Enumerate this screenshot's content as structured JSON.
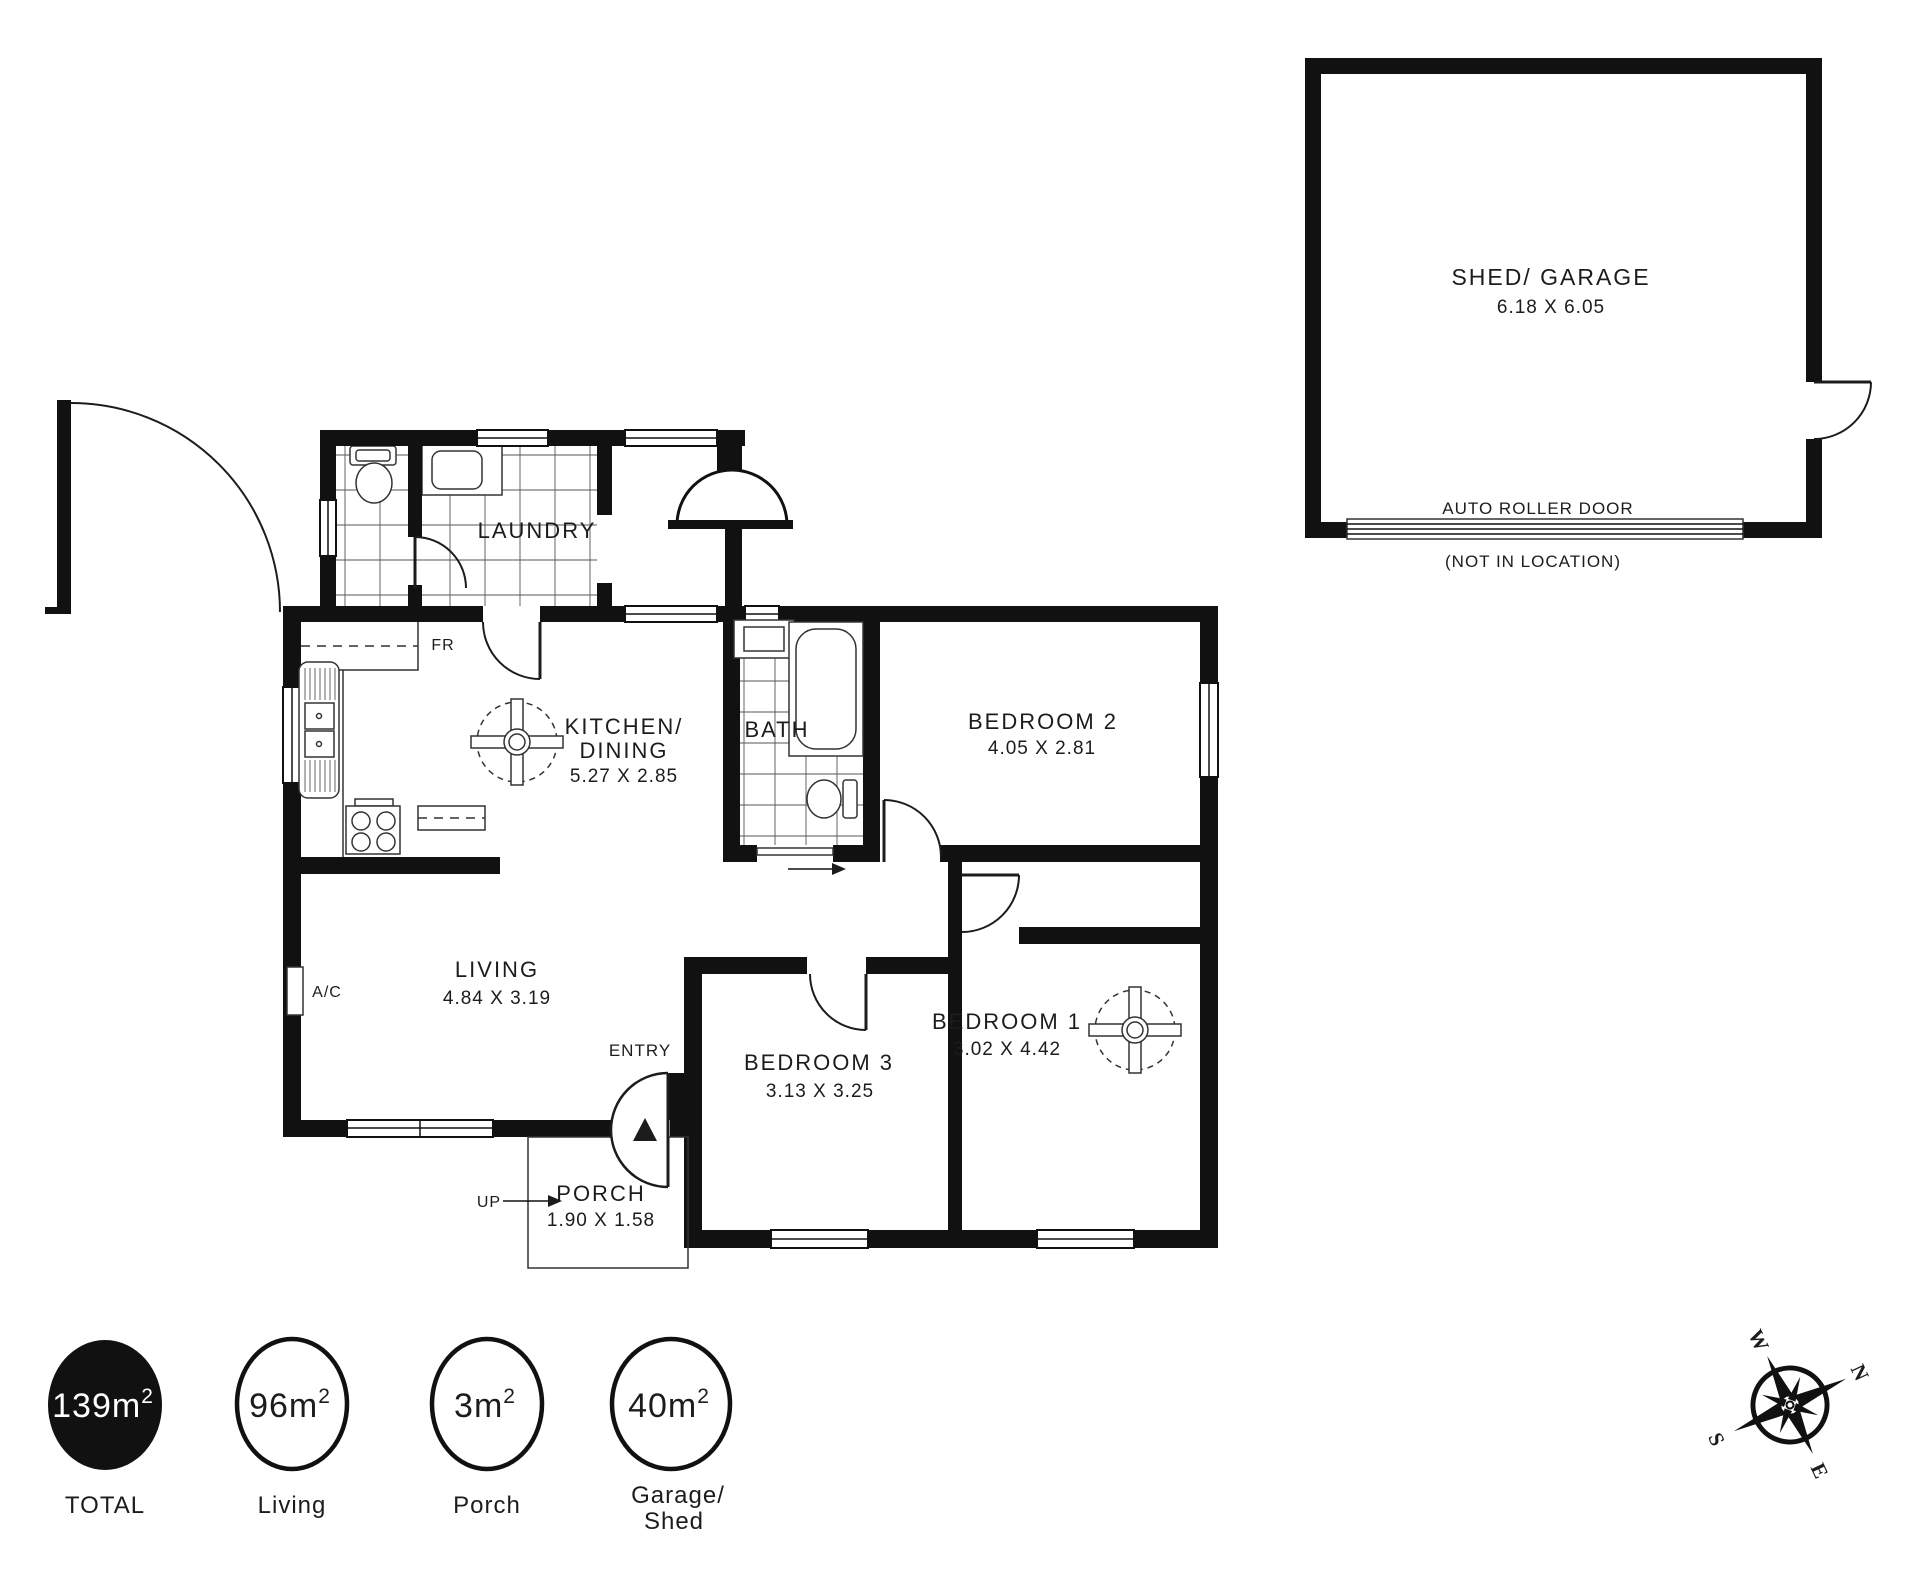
{
  "ink": "#1c1c1c",
  "paper": "#ffffff",
  "rooms": {
    "laundry": {
      "name": "LAUNDRY"
    },
    "kitchen": {
      "name": "KITCHEN/",
      "name2": "DINING",
      "dims": "5.27 X 2.85"
    },
    "bath": {
      "name": "BATH"
    },
    "bedroom2": {
      "name": "BEDROOM 2",
      "dims": "4.05 X 2.81"
    },
    "bedroom3": {
      "name": "BEDROOM 3",
      "dims": "3.13 X 3.25"
    },
    "bedroom1": {
      "name": "BEDROOM 1",
      "dims": "3.02 X 4.42"
    },
    "living": {
      "name": "LIVING",
      "dims": "4.84 X 3.19"
    },
    "porch": {
      "name": "PORCH",
      "dims": "1.90 X 1.58"
    },
    "shed": {
      "name": "SHED/ GARAGE",
      "dims": "6.18 X 6.05",
      "door_label": "AUTO ROLLER DOOR",
      "door_note": "(NOT IN LOCATION)"
    }
  },
  "annotations": {
    "entry": "ENTRY",
    "up": "UP",
    "fridge": "FR",
    "ac": "A/C"
  },
  "legend": {
    "total": {
      "value": "139m",
      "sup": "2",
      "label": "TOTAL"
    },
    "living": {
      "value": "96m",
      "sup": "2",
      "label": "Living"
    },
    "porch": {
      "value": "3m",
      "sup": "2",
      "label": "Porch"
    },
    "garage": {
      "value": "40m",
      "sup": "2",
      "label": "Garage/",
      "label2": "Shed"
    }
  },
  "compass": {
    "n": "N",
    "e": "E",
    "s": "S",
    "w": "W"
  }
}
